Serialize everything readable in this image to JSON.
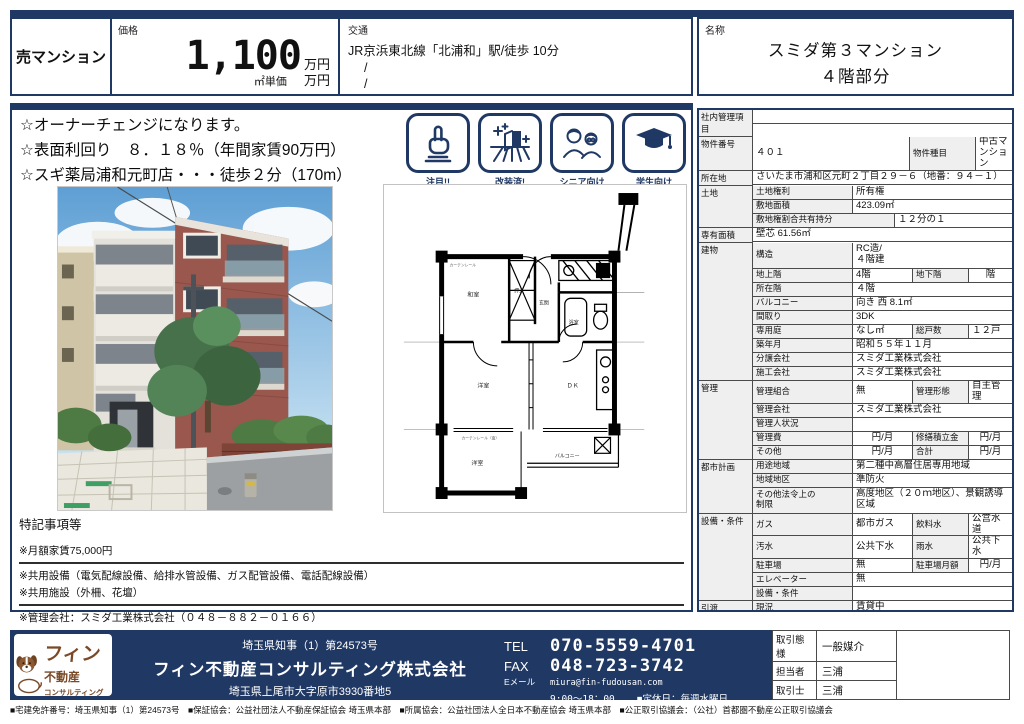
{
  "colors": {
    "navy": "#1f3864",
    "label_bg": "#efefef",
    "border_dark": "#4a4a4a",
    "logo_brown": "#7a4a28"
  },
  "header": {
    "category": "売マンション",
    "price": {
      "label": "価格",
      "value": "1,100",
      "unit": "万円",
      "unit_price_label": "㎡単価",
      "unit_price_unit": "万円"
    },
    "transport": {
      "label": "交通",
      "line1": "JR京浜東北線「北浦和」駅/徒歩 10分",
      "line2": "/",
      "line3": "/"
    },
    "name": {
      "label": "名称",
      "line1": "スミダ第３マンション",
      "line2": "４階部分"
    }
  },
  "highlights": [
    "☆オーナーチェンジになります。",
    "☆表面利回り　８．１８％（年間家賃90万円）",
    "☆スギ薬局浦和元町店・・・徒歩２分（170m）"
  ],
  "badges": [
    {
      "icon": "pointing-hand-icon",
      "label": "注目!!"
    },
    {
      "icon": "renovated-icon",
      "label": "改装済!"
    },
    {
      "icon": "seniors-icon",
      "label": "シニア向け"
    },
    {
      "icon": "student-icon",
      "label": "学生向け"
    }
  ],
  "floor_plan": {
    "labels": {
      "washitsu": "和室",
      "oshiire": "押入",
      "genkan": "玄関",
      "bath": "浴室",
      "youshitsu": "洋室",
      "dk": "ＤＫ",
      "balcony": "バルコニー",
      "room_south": "洋室",
      "curtain1": "カーテンレール",
      "curtain2": "カーテンレール（南）"
    }
  },
  "special_notes": {
    "title": "特記事項等",
    "lines": [
      {
        "t": "※月額家賃75,000円",
        "hr": true
      },
      {
        "t": "※共用設備（電気配線設備、給排水管設備、ガス配管設備、電話配線設備）",
        "hr": false
      },
      {
        "t": "※共用施設（外柵、花壇）",
        "hr": true
      },
      {
        "t": "※管理会社：スミダ工業株式会社（０４８－８８２－０１６６）",
        "hr": false
      }
    ]
  },
  "details": {
    "groups": [
      {
        "label": "社内管理項目",
        "rows": [
          [
            {
              "t": "",
              "last": true
            }
          ]
        ]
      },
      {
        "label": "物件番号",
        "rows": [
          [
            {
              "t": "４０１",
              "w": 157
            },
            {
              "t": "物件種目",
              "h": true,
              "w": 66
            },
            {
              "t": "中古マンション",
              "last": true
            }
          ]
        ]
      },
      {
        "label": "所在地",
        "rows": [
          [
            {
              "t": "さいたま市浦和区元町２丁目２９－６（地番：９４－１）",
              "last": true
            }
          ]
        ]
      },
      {
        "label": "土地",
        "rows": [
          [
            {
              "t": "土地権利",
              "h": true,
              "w": 100
            },
            {
              "t": "所有権",
              "last": true
            }
          ],
          [
            {
              "t": "敷地面積",
              "h": true,
              "w": 100
            },
            {
              "t": "423.09㎡",
              "last": true
            }
          ],
          [
            {
              "t": "敷地権割合共有持分",
              "h": true,
              "w": 142
            },
            {
              "t": "１２分の１",
              "last": true
            }
          ]
        ]
      },
      {
        "label": "専有面積",
        "rows": [
          [
            {
              "t": "壁芯 61.56㎡",
              "last": true
            }
          ]
        ]
      },
      {
        "label": "建物",
        "rows": [
          [
            {
              "t": "構造",
              "h": true,
              "w": 100
            },
            {
              "t": "RC造/\n４階建",
              "last": true,
              "ht": 26
            }
          ],
          [
            {
              "t": "地上階",
              "h": true,
              "w": 100
            },
            {
              "t": "4階",
              "w": 60
            },
            {
              "t": "地下階",
              "h": true,
              "w": 56
            },
            {
              "t": "階",
              "last": true,
              "c": true
            }
          ],
          [
            {
              "t": "所在階",
              "h": true,
              "w": 100
            },
            {
              "t": "４階",
              "last": true
            }
          ],
          [
            {
              "t": "バルコニー",
              "h": true,
              "w": 100
            },
            {
              "t": "向き 西 8.1㎡",
              "last": true
            }
          ],
          [
            {
              "t": "間取り",
              "h": true,
              "w": 100
            },
            {
              "t": "3DK",
              "last": true
            }
          ],
          [
            {
              "t": "専用庭",
              "h": true,
              "w": 100
            },
            {
              "t": "なし㎡",
              "w": 60
            },
            {
              "t": "総戸数",
              "h": true,
              "w": 56
            },
            {
              "t": "１２戸",
              "last": true
            }
          ],
          [
            {
              "t": "築年月",
              "h": true,
              "w": 100
            },
            {
              "t": "昭和５５年１１月",
              "last": true
            }
          ],
          [
            {
              "t": "分譲会社",
              "h": true,
              "w": 100
            },
            {
              "t": "スミダ工業株式会社",
              "last": true
            }
          ],
          [
            {
              "t": "施工会社",
              "h": true,
              "w": 100
            },
            {
              "t": "スミダ工業株式会社",
              "last": true
            }
          ]
        ]
      },
      {
        "label": "管理",
        "rows": [
          [
            {
              "t": "管理組合",
              "h": true,
              "w": 100
            },
            {
              "t": "無",
              "w": 60
            },
            {
              "t": "管理形態",
              "h": true,
              "w": 56
            },
            {
              "t": "自主管理",
              "last": true
            }
          ],
          [
            {
              "t": "管理会社",
              "h": true,
              "w": 100
            },
            {
              "t": "スミダ工業株式会社",
              "last": true
            }
          ],
          [
            {
              "t": "管理人状況",
              "h": true,
              "w": 100
            },
            {
              "t": "",
              "last": true
            }
          ],
          [
            {
              "t": "管理費",
              "h": true,
              "w": 100
            },
            {
              "t": "円/月",
              "w": 60,
              "c": true
            },
            {
              "t": "修繕積立金",
              "h": true,
              "w": 56
            },
            {
              "t": "円/月",
              "last": true,
              "c": true
            }
          ],
          [
            {
              "t": "その他",
              "h": true,
              "w": 100
            },
            {
              "t": "円/月",
              "w": 60,
              "c": true
            },
            {
              "t": "合計",
              "h": true,
              "w": 56
            },
            {
              "t": "円/月",
              "last": true,
              "c": true
            }
          ]
        ]
      },
      {
        "label": "都市計画",
        "rows": [
          [
            {
              "t": "用途地域",
              "h": true,
              "w": 100
            },
            {
              "t": "第二種中高層住居専用地域",
              "last": true
            }
          ],
          [
            {
              "t": "地域地区",
              "h": true,
              "w": 100
            },
            {
              "t": "準防火",
              "last": true
            }
          ],
          [
            {
              "t": "その他法令上の\n制限",
              "h": true,
              "w": 100,
              "ht": 26
            },
            {
              "t": "高度地区（２０ｍ地区）、景観誘導区域",
              "last": true
            }
          ]
        ]
      },
      {
        "label": "設備・条件",
        "rows": [
          [
            {
              "t": "ガス",
              "h": true,
              "w": 100
            },
            {
              "t": "都市ガス",
              "w": 60
            },
            {
              "t": "飲料水",
              "h": true,
              "w": 56
            },
            {
              "t": "公営水道",
              "last": true
            }
          ],
          [
            {
              "t": "汚水",
              "h": true,
              "w": 100
            },
            {
              "t": "公共下水",
              "w": 60
            },
            {
              "t": "雨水",
              "h": true,
              "w": 56
            },
            {
              "t": "公共下水",
              "last": true
            }
          ],
          [
            {
              "t": "駐車場",
              "h": true,
              "w": 100
            },
            {
              "t": "無",
              "w": 60
            },
            {
              "t": "駐車場月額",
              "h": true,
              "w": 56
            },
            {
              "t": "円/月",
              "last": true,
              "c": true
            }
          ],
          [
            {
              "t": "エレベーター",
              "h": true,
              "w": 100
            },
            {
              "t": "無",
              "last": true
            }
          ],
          [
            {
              "t": "設備・条件",
              "h": true,
              "w": 100
            },
            {
              "t": "",
              "last": true
            }
          ]
        ]
      },
      {
        "label": "引渡",
        "rows": [
          [
            {
              "t": "現況",
              "h": true,
              "w": 100
            },
            {
              "t": "賃貸中",
              "last": true
            }
          ],
          [
            {
              "t": "引渡時期",
              "h": true,
              "w": 100
            },
            {
              "t": "相談",
              "last": true
            }
          ]
        ]
      },
      {
        "label": "備考",
        "rows": [
          [
            {
              "t": "",
              "last": true,
              "ht": 18
            }
          ]
        ]
      }
    ]
  },
  "footer": {
    "license": "埼玉県知事（1）第24573号",
    "company": "フィン不動産コンサルティング株式会社",
    "address": "埼玉県上尾市大字原市3930番地5",
    "logo": {
      "line1": "フィン",
      "line2": "不動産",
      "line3": "コンサルティング"
    },
    "tel_label": "TEL",
    "tel": "070-5559-4701",
    "fax_label": "FAX",
    "fax": "048-723-3742",
    "email_label": "Eメール",
    "email": "miura@fin-fudousan.com",
    "hours": "9:00～18：00",
    "closed": "■定休日：毎週水曜日",
    "deal": [
      {
        "label": "取引態様",
        "value": "一般媒介"
      },
      {
        "label": "担当者",
        "value": "三浦"
      },
      {
        "label": "取引士",
        "value": "三浦"
      }
    ],
    "fineprint": "■宅建免許番号：埼玉県知事（1）第24573号　■保証協会：公益社団法人不動産保証協会 埼玉県本部　■所属協会：公益社団法人全日本不動産協会 埼玉県本部　■公正取引協議会：（公社）首都圏不動産公正取引協議会"
  }
}
